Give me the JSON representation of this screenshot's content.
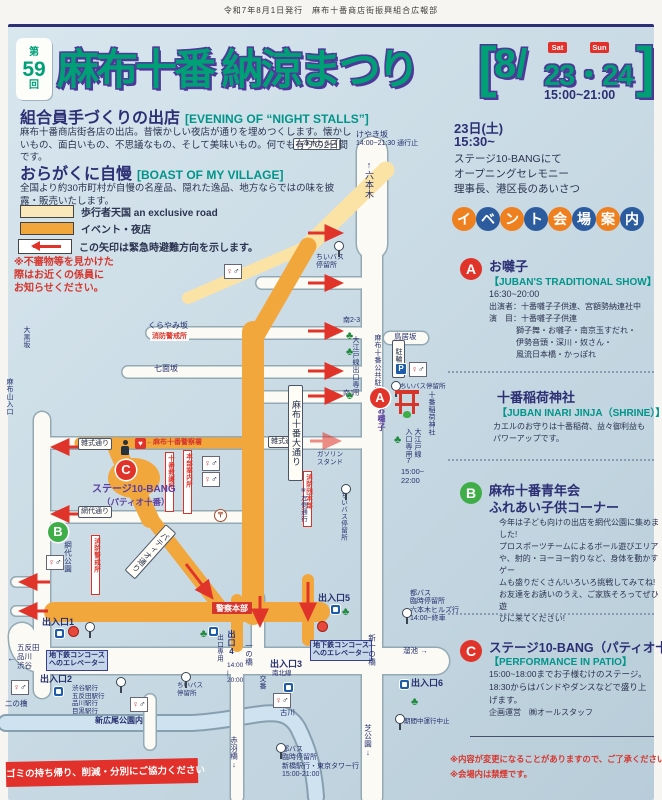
{
  "meta": {
    "publisher": "令和7年8月1日発行　麻布十番商店街振興組合広報部"
  },
  "header": {
    "edition_pre": "第",
    "edition_no": "59",
    "edition_post": "回",
    "title": "麻布十番 納涼まつり",
    "bracket_l": "[",
    "bracket_r": "]",
    "month": "8/",
    "days": "23・24",
    "sat": "Sat",
    "sun": "Sun",
    "time": "15:00~21:00"
  },
  "intro": {
    "s1_title": "組合員手づくりの出店",
    "s1_en": "[EVENING OF “NIGHT STALLS”]",
    "s1_body": "麻布十番商店街各店の出店。昔懐かしい夜店が通りを埋めつくします。懐かしいもの、面白いもの、不思議なもの、そして美味いもの。何でも有りの2日間です。",
    "s2_title": "おらがくに自慢",
    "s2_en": "[BOAST OF MY VILLAGE]",
    "s2_body": "全国より約30市町村が自慢の名産品、隠れた逸品、地方ならではの味を披露・販売いたします。",
    "legend": [
      {
        "label": "歩行者天国 an exclusive road"
      },
      {
        "label": "イベント・夜店"
      },
      {
        "label": "この矢印は緊急時避難方向を示します。"
      }
    ],
    "warning": "※不審物等を見かけた\n際はお近くの係員に\nお知らせください。"
  },
  "right": {
    "day": "23日(土)",
    "start": "15:30~",
    "opening": "ステージ10-BANGにて\nオープニングセレモニー\n理事長、港区長のあいさつ",
    "venue_badge": [
      {
        "ch": "イ",
        "c": "o"
      },
      {
        "ch": "ベ",
        "c": "b"
      },
      {
        "ch": "ン",
        "c": "o"
      },
      {
        "ch": "ト",
        "c": "b"
      },
      {
        "ch": "会",
        "c": "o"
      },
      {
        "ch": "場",
        "c": "b"
      },
      {
        "ch": "案",
        "c": "o"
      },
      {
        "ch": "内",
        "c": "b"
      }
    ],
    "section_a": {
      "badge": "A",
      "title": "お囃子",
      "en": "【JUBAN'S TRADITIONAL SHOW】",
      "time": "16:30~20:00",
      "cast": "出演者：十番囃子子供連、宮額勢納連社中",
      "program_head": "演　目：十番囃子子供連",
      "program_rest": "獅子舞・お囃子・南京玉すだれ・\n伊勢音頭・深川・奴さん・\n風流日本橋・かっぽれ"
    },
    "shrine": {
      "title": "十番稲荷神社",
      "en": "【JUBAN INARI JINJA（SHRINE）】",
      "body": "カエルのお守りは十番稲荷、益々御利益も\nパワーアップです。"
    },
    "section_b": {
      "badge": "B",
      "title1": "麻布十番青年会",
      "title2": "ふれあい子供コーナー",
      "body": "今年は子ども向けの出店を網代公園に集めま\nした!\nプロスポーツチームによるボール遊びエリア\nや、射的・ヨーヨー釣りなど、身体を動かすゲー\nムも盛りだくさん!いろいろ挑戦してみてね!\nお友達をお誘いのうえ、ご家族そろってぜひ遊\nびに来てください!"
    },
    "section_c": {
      "badge": "C",
      "title": "ステージ10-BANG（パティオ十番）",
      "en": "【PERFORMANCE IN PATIO】",
      "body": "15:00~18:00までお子様むけのステージ。\n18:30からはバンドやダンスなどで盛り上\nげます。",
      "credit": "企画運営　㈱オールスタッフ"
    },
    "notes": [
      "※内容が変更になることがありますので、ご了承ください。",
      "※会場内は禁煙です。"
    ]
  },
  "footer": {
    "note": "ゴミの持ち帰り、削減・分別にご協力ください"
  },
  "map": {
    "labels": [
      {
        "t": "六本木ヒルズ",
        "x": 293,
        "y": 138,
        "c": "wbox",
        "fs": 7,
        "n": "roppongi-hills-label"
      },
      {
        "t": "けやき坂",
        "x": 356,
        "y": 130,
        "fs": 8
      },
      {
        "t": "14:00~21:30 通行止",
        "x": 356,
        "y": 140,
        "fs": 7
      },
      {
        "t": "↑六本木",
        "x": 364,
        "y": 160,
        "c": "v",
        "fs": 9,
        "h": 54,
        "n": "roppongi-street-label"
      },
      {
        "t": "ちいバス\n停留所",
        "x": 316,
        "y": 254,
        "c": "pre",
        "fs": 7
      },
      {
        "t": "南2-3",
        "x": 343,
        "y": 317,
        "fs": 7
      },
      {
        "t": "くらやみ坂",
        "x": 148,
        "y": 321,
        "fs": 8
      },
      {
        "t": "消防警戒所",
        "x": 150,
        "y": 333,
        "c": "redw",
        "fs": 7
      },
      {
        "t": "鳥居坂",
        "x": 394,
        "y": 333,
        "fs": 7.5
      },
      {
        "t": "大黒坂",
        "x": 23,
        "y": 326,
        "c": "v",
        "fs": 7,
        "h": 36
      },
      {
        "t": "七面坂",
        "x": 154,
        "y": 364,
        "fs": 8
      },
      {
        "t": "駐輪場",
        "x": 392,
        "y": 340,
        "c": "wbox v",
        "fs": 7,
        "h": 34
      },
      {
        "t": "麻布十番公共駐車場",
        "x": 374,
        "y": 334,
        "c": "v",
        "fs": 7,
        "h": 86
      },
      {
        "t": "大江戸線出口専用",
        "x": 352,
        "y": 336,
        "c": "v",
        "fs": 7,
        "h": 104
      },
      {
        "t": "南1",
        "x": 343,
        "y": 390,
        "fs": 7
      },
      {
        "t": "ちいバス停留所",
        "x": 400,
        "y": 383,
        "fs": 6.5
      },
      {
        "t": "お囃子",
        "x": 377,
        "y": 406,
        "c": "purple v",
        "fs": 8,
        "h": 36
      },
      {
        "t": "十番稲荷神社",
        "x": 428,
        "y": 391,
        "c": "v",
        "fs": 7,
        "h": 66,
        "n": "juban-inari-label"
      },
      {
        "t": "大江戸線",
        "x": 414,
        "y": 428,
        "c": "v",
        "fs": 7,
        "h": 38
      },
      {
        "t": "入口専用7",
        "x": 405,
        "y": 428,
        "c": "v",
        "fs": 7,
        "h": 44
      },
      {
        "t": "15:00~\n22:00",
        "x": 401,
        "y": 468,
        "c": "pre",
        "fs": 7.5
      },
      {
        "t": "雑式通り",
        "x": 78,
        "y": 438,
        "c": "wbox",
        "fs": 7
      },
      {
        "t": "雑式通り",
        "x": 268,
        "y": 436,
        "c": "wbox",
        "fs": 7
      },
      {
        "t": "←麻布十番警察署",
        "x": 146,
        "y": 439,
        "c": "red",
        "fs": 7
      },
      {
        "t": "ガソリン\nスタンド",
        "x": 317,
        "y": 451,
        "c": "pre",
        "fs": 6.5
      },
      {
        "t": "消防団本部",
        "x": 303,
        "y": 471,
        "c": "redbox v",
        "fs": 6.5,
        "h": 50
      },
      {
        "t": "十番救護所",
        "x": 165,
        "y": 452,
        "c": "redbox v",
        "fs": 6.5,
        "h": 54
      },
      {
        "t": "本部案内所",
        "x": 183,
        "y": 450,
        "c": "redbox v",
        "fs": 6.5,
        "h": 58
      },
      {
        "t": "ステージ10-BANG",
        "x": 92,
        "y": 484,
        "c": "purple",
        "fs": 10,
        "n": "stage-10bang-label"
      },
      {
        "t": "（パティオ十番）",
        "x": 102,
        "y": 497,
        "c": "purple",
        "fs": 8.5
      },
      {
        "t": "麻布十番大通り",
        "x": 288,
        "y": 385,
        "c": "wbox v",
        "fs": 9,
        "h": 92,
        "n": "juban-odori-label"
      },
      {
        "t": "※左側通行",
        "x": 299,
        "y": 486,
        "c": "v",
        "fs": 6.5,
        "h": 50
      },
      {
        "t": "パティオ通り",
        "x": 166,
        "y": 524,
        "c": "wbox v diag",
        "fs": 8,
        "h": 58
      },
      {
        "t": "網代通り",
        "x": 78,
        "y": 506,
        "c": "wbox",
        "fs": 7
      },
      {
        "t": "網代公園",
        "x": 64,
        "y": 541,
        "c": "v",
        "fs": 7.5,
        "h": 46,
        "n": "ajiro-park-label"
      },
      {
        "t": "消防警戒所",
        "x": 91,
        "y": 535,
        "c": "redbox v",
        "fs": 6.5,
        "h": 54
      },
      {
        "t": "麻布山入口",
        "x": 6,
        "y": 378,
        "c": "v",
        "fs": 7,
        "h": 52
      },
      {
        "t": "ちいバス停留所",
        "x": 339,
        "y": 492,
        "c": "v",
        "fs": 6.5,
        "h": 80
      },
      {
        "t": "警察本部",
        "x": 212,
        "y": 602,
        "c": "redfill",
        "fs": 8,
        "n": "police-hq-label"
      },
      {
        "t": "出口専用",
        "x": 215,
        "y": 634,
        "c": "v",
        "fs": 6.5,
        "h": 42
      },
      {
        "t": "出口4",
        "x": 227,
        "y": 630,
        "c": "lbB v",
        "fs": 8,
        "h": 30
      },
      {
        "t": "14:00\n|\n20:00",
        "x": 227,
        "y": 662,
        "c": "pre",
        "fs": 6.5
      },
      {
        "t": "一の橋",
        "x": 245,
        "y": 642,
        "c": "v",
        "fs": 7.5,
        "h": 40
      },
      {
        "t": "出入口1",
        "x": 42,
        "y": 617,
        "c": "lbB"
      },
      {
        "t": "地下鉄コンコース\nへのエレベーター",
        "x": 46,
        "y": 650,
        "c": "bluebox",
        "fs": 7
      },
      {
        "t": "出入口2",
        "x": 40,
        "y": 674,
        "c": "lbB"
      },
      {
        "t": "←",
        "x": 7,
        "y": 653,
        "fs": 9
      },
      {
        "t": "五反田\n品川\n渋谷",
        "x": 17,
        "y": 644,
        "c": "pre",
        "fs": 7.5
      },
      {
        "t": "二の橋",
        "x": 5,
        "y": 700,
        "fs": 7.5
      },
      {
        "t": "渋谷駅行\n五反田駅行\n品川駅行\n目黒駅行",
        "x": 72,
        "y": 685,
        "c": "pre",
        "fs": 6.5
      },
      {
        "t": "新広尾公園内",
        "x": 95,
        "y": 716,
        "c": "lbB",
        "fs": 8
      },
      {
        "t": "ちいバス\n停留所",
        "x": 177,
        "y": 682,
        "c": "pre",
        "fs": 6.5
      },
      {
        "t": "古川",
        "x": 280,
        "y": 709,
        "fs": 7.5
      },
      {
        "t": "交番",
        "x": 259,
        "y": 675,
        "c": "v",
        "fs": 7,
        "h": 24
      },
      {
        "t": "出入口3",
        "x": 270,
        "y": 659,
        "c": "lbB"
      },
      {
        "t": "南北線",
        "x": 272,
        "y": 670,
        "fs": 6.5
      },
      {
        "t": "出入口5",
        "x": 318,
        "y": 593,
        "c": "lbB"
      },
      {
        "t": "地下鉄コンコース\nへのエレベーター",
        "x": 310,
        "y": 640,
        "c": "bluebox",
        "fs": 7
      },
      {
        "t": "新一の橋",
        "x": 368,
        "y": 634,
        "c": "v",
        "fs": 7.5,
        "h": 46
      },
      {
        "t": "溜池 →",
        "x": 403,
        "y": 647,
        "fs": 7.5
      },
      {
        "t": "出入口6",
        "x": 411,
        "y": 678,
        "c": "lbB"
      },
      {
        "t": "期間中運行中止",
        "x": 404,
        "y": 718,
        "fs": 6.5
      },
      {
        "t": "芝公園↓",
        "x": 364,
        "y": 724,
        "c": "v",
        "fs": 7.5,
        "h": 48
      },
      {
        "t": "赤羽橋↓",
        "x": 230,
        "y": 736,
        "c": "v",
        "fs": 7.5,
        "h": 48
      },
      {
        "t": "都バス\n臨時停留所\n六本木ヒルズ行\n14:00~終車",
        "x": 410,
        "y": 590,
        "c": "pre",
        "fs": 7
      },
      {
        "t": "都バス\n臨時停留所\n新橋駅行・東京タワー行\n15:00-21:00",
        "x": 282,
        "y": 746,
        "c": "pre",
        "fs": 7
      },
      {
        "t": "A",
        "x": 370,
        "y": 388,
        "c": "circ r",
        "n": "venue-marker-a"
      },
      {
        "t": "B",
        "x": 48,
        "y": 522,
        "c": "circ g",
        "n": "venue-marker-b"
      },
      {
        "t": "C",
        "x": 116,
        "y": 460,
        "c": "circ r",
        "n": "venue-marker-c"
      }
    ],
    "icons": [
      {
        "ic": "busstop",
        "x": 334,
        "y": 241
      },
      {
        "ic": "toilet",
        "x": 224,
        "y": 264
      },
      {
        "ic": "tree",
        "x": 346,
        "y": 326
      },
      {
        "ic": "tree",
        "x": 346,
        "y": 342
      },
      {
        "ic": "tree",
        "x": 346,
        "y": 386
      },
      {
        "ic": "p",
        "x": 396,
        "y": 364
      },
      {
        "ic": "toilet",
        "x": 409,
        "y": 362
      },
      {
        "ic": "busstop",
        "x": 391,
        "y": 381
      },
      {
        "ic": "torii",
        "x": 397,
        "y": 390
      },
      {
        "ic": "frog",
        "x": 403,
        "y": 411
      },
      {
        "ic": "tree",
        "x": 394,
        "y": 430
      },
      {
        "ic": "busstop",
        "x": 341,
        "y": 484
      },
      {
        "ic": "officer",
        "x": 120,
        "y": 440
      },
      {
        "ic": "aed",
        "x": 135,
        "y": 438
      },
      {
        "ic": "toilet",
        "x": 202,
        "y": 456
      },
      {
        "ic": "toilet",
        "x": 202,
        "y": 472
      },
      {
        "ic": "post",
        "x": 214,
        "y": 509
      },
      {
        "ic": "toilet",
        "x": 46,
        "y": 555
      },
      {
        "ic": "metro",
        "x": 55,
        "y": 629
      },
      {
        "ic": "exitdot",
        "x": 68,
        "y": 626
      },
      {
        "ic": "busstop",
        "x": 85,
        "y": 622
      },
      {
        "ic": "toilet",
        "x": 11,
        "y": 680
      },
      {
        "ic": "metro",
        "x": 54,
        "y": 687
      },
      {
        "ic": "busstop",
        "x": 116,
        "y": 677
      },
      {
        "ic": "toilet",
        "x": 130,
        "y": 697
      },
      {
        "ic": "busstop",
        "x": 181,
        "y": 672
      },
      {
        "ic": "metro",
        "x": 284,
        "y": 683
      },
      {
        "ic": "toilet",
        "x": 273,
        "y": 693
      },
      {
        "ic": "metro",
        "x": 331,
        "y": 605
      },
      {
        "ic": "tree",
        "x": 342,
        "y": 602
      },
      {
        "ic": "exitdot",
        "x": 317,
        "y": 621
      },
      {
        "ic": "metro",
        "x": 209,
        "y": 627
      },
      {
        "ic": "tree",
        "x": 200,
        "y": 624
      },
      {
        "ic": "metro",
        "x": 400,
        "y": 680
      },
      {
        "ic": "tree",
        "x": 411,
        "y": 692
      },
      {
        "ic": "busstop",
        "x": 395,
        "y": 714
      },
      {
        "ic": "busstop",
        "x": 276,
        "y": 743
      },
      {
        "ic": "busstop",
        "x": 402,
        "y": 608
      }
    ]
  }
}
